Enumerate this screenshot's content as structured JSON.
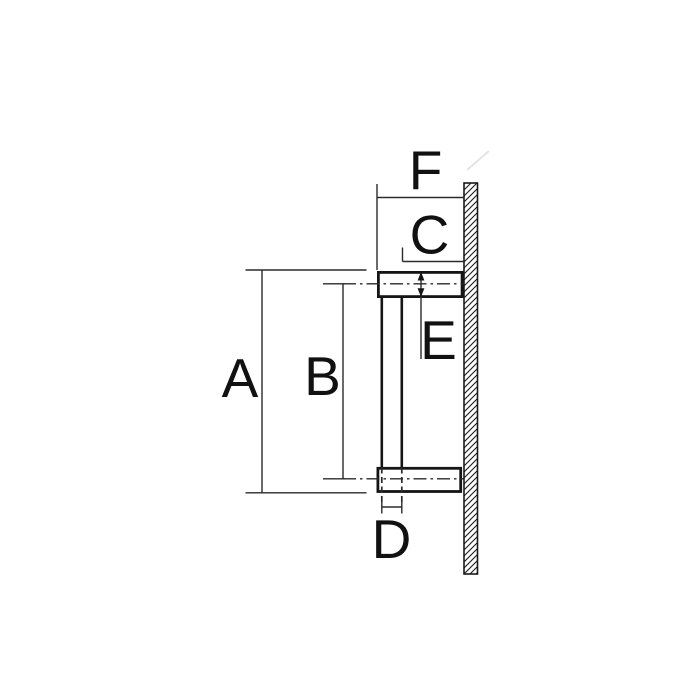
{
  "drawing": {
    "background_color": "#ffffff",
    "line_color": "#1a1a1a",
    "label_color": "#111111",
    "dimension_labels": {
      "a": "A",
      "b": "B",
      "c": "C",
      "d": "D",
      "e": "E",
      "f": "F"
    }
  }
}
